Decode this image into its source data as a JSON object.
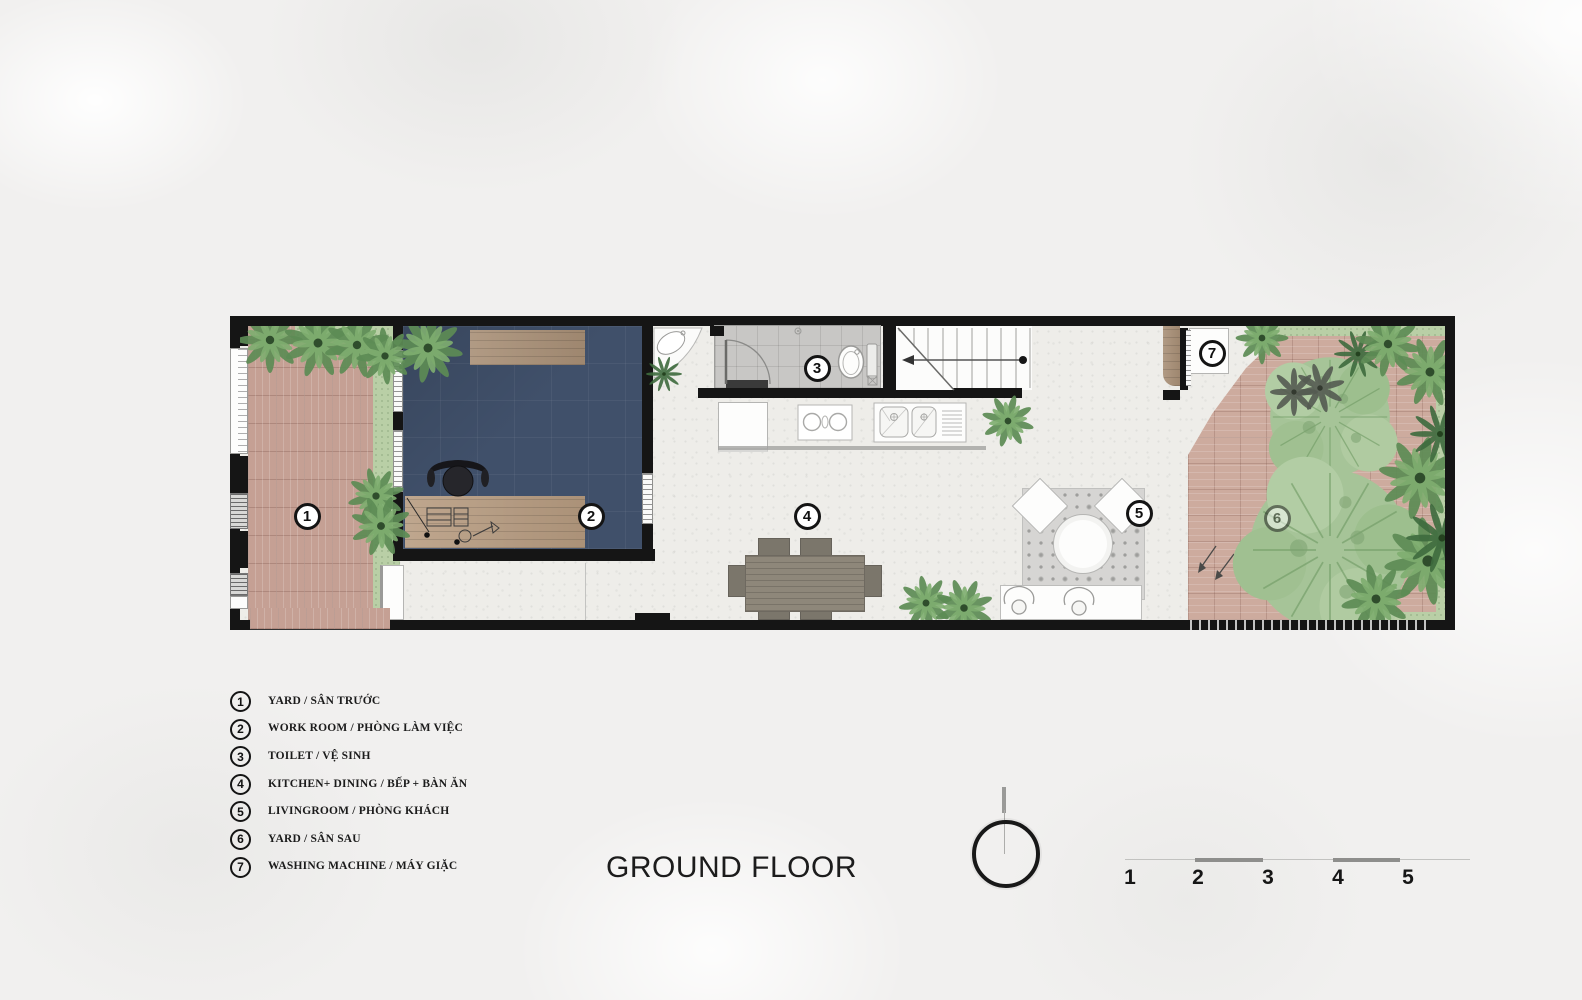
{
  "title": "GROUND FLOOR",
  "plan": {
    "markers": [
      "1",
      "2",
      "3",
      "4",
      "5",
      "6",
      "7"
    ]
  },
  "legend": {
    "items": [
      {
        "num": "1",
        "label": "YARD / SÂN TRƯỚC"
      },
      {
        "num": "2",
        "label": "WORK ROOM / PHÒNG LÀM VIỆC"
      },
      {
        "num": "3",
        "label": "TOILET / VỆ SINH"
      },
      {
        "num": "4",
        "label": "KITCHEN+ DINING / BẾP + BÀN ĂN"
      },
      {
        "num": "5",
        "label": "LIVINGROOM / PHÒNG KHÁCH"
      },
      {
        "num": "6",
        "label": "YARD / SÂN SAU"
      },
      {
        "num": "7",
        "label": "WASHING MACHINE / MÁY GIẶC"
      }
    ]
  },
  "scale_bar": {
    "labels": [
      "1",
      "2",
      "3",
      "4",
      "5"
    ]
  },
  "colors": {
    "wall": "#151515",
    "workroom_floor": "#40506a",
    "front_paving": "#c5a094",
    "back_paving": "#cdab9e",
    "planting_green": "#b9cfa6",
    "terrazzo_floor": "#eeede9",
    "wood": "#a88f76"
  }
}
